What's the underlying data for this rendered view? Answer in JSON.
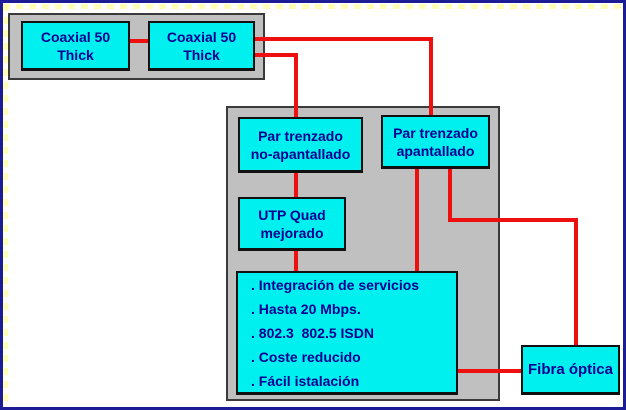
{
  "diagram": {
    "title": "Tipos de cableado de red",
    "colors": {
      "node_fill": "#00f0f0",
      "container_fill": "#c0c0c0",
      "connector": "#ee0f0f",
      "text": "#000090",
      "outer_border": "#1c1c96",
      "node_border": "#111111"
    },
    "nodes": {
      "coax1": {
        "line1": "Coaxial 50",
        "line2": "Thick"
      },
      "coax2": {
        "line1": "Coaxial 50",
        "line2": "Thick"
      },
      "noapant": {
        "line1": "Par trenzado",
        "line2": "no-apantallado"
      },
      "apant": {
        "line1": "Par trenzado",
        "line2": "apantallado"
      },
      "quad": {
        "line1": "UTP Quad",
        "line2": "mejorado"
      },
      "fibra": {
        "label": "Fibra óptica"
      },
      "services": {
        "items": [
          ". Integración de servicios",
          ". Hasta 20 Mbps.",
          ". 802.3  802.5 ISDN",
          ". Coste reducido",
          ". Fácil istalación"
        ]
      }
    }
  }
}
